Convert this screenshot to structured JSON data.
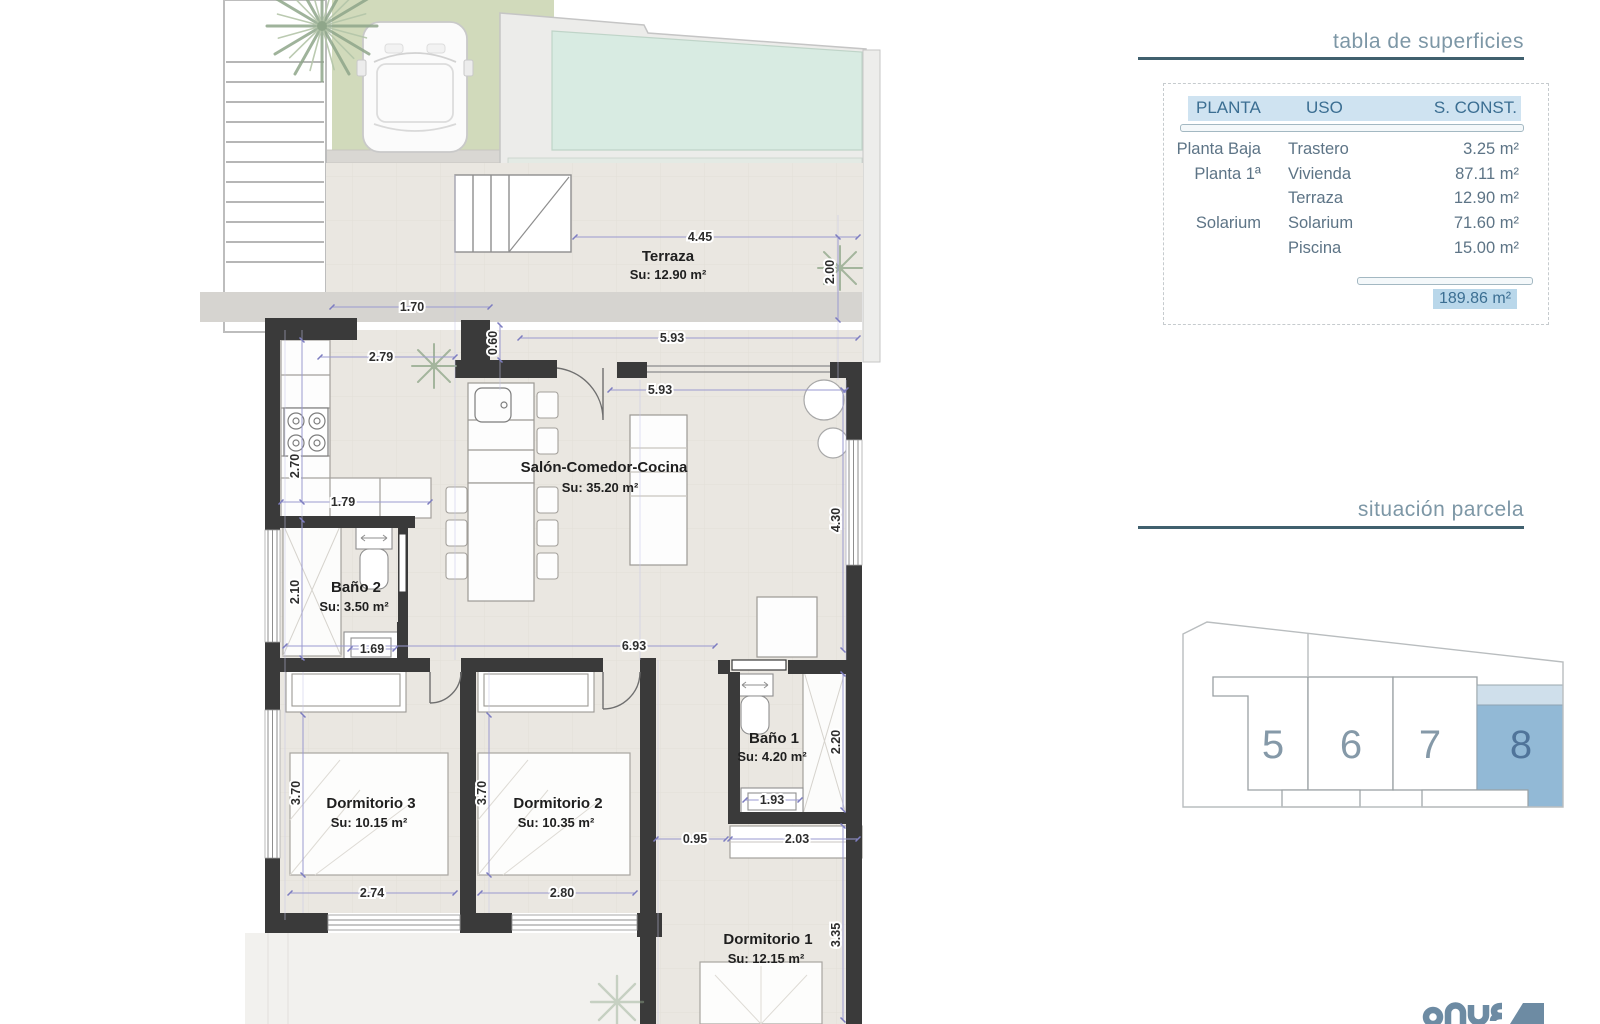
{
  "panel": {
    "surfaces_title": "tabla de superficies",
    "parcel_title": "situación parcela",
    "table": {
      "headers": [
        "PLANTA",
        "USO",
        "S. CONST."
      ],
      "rows": [
        {
          "planta": "Planta Baja",
          "uso": "Trastero",
          "sconst": "3.25 m²"
        },
        {
          "planta": "Planta 1ª",
          "uso": "Vivienda",
          "sconst": "87.11 m²"
        },
        {
          "planta": "",
          "uso": "Terraza",
          "sconst": "12.90 m²"
        },
        {
          "planta": "Solarium",
          "uso": "Solarium",
          "sconst": "71.60 m²"
        },
        {
          "planta": "",
          "uso": "Piscina",
          "sconst": "15.00 m²"
        }
      ],
      "total": "189.86 m²"
    },
    "plots": {
      "p5": "5",
      "p6": "6",
      "p7": "7",
      "p8": "8",
      "highlighted": "8"
    }
  },
  "plan": {
    "rooms": {
      "terraza": {
        "name": "Terraza",
        "su": "Su: 12.90 m²"
      },
      "salon": {
        "name": "Salón-Comedor-Cocina",
        "su": "Su: 35.20 m²"
      },
      "bano2": {
        "name": "Baño 2",
        "su": "Su: 3.50 m²"
      },
      "bano1": {
        "name": "Baño 1",
        "su": "Su: 4.20 m²"
      },
      "dorm3": {
        "name": "Dormitorio 3",
        "su": "Su: 10.15 m²"
      },
      "dorm2": {
        "name": "Dormitorio 2",
        "su": "Su: 10.35 m²"
      },
      "dorm1": {
        "name": "Dormitorio 1",
        "su": "Su: 12.15 m²"
      }
    },
    "dims": {
      "d445": "4.45",
      "d200": "2.00",
      "d170": "1.70",
      "d060": "0.60",
      "d593a": "5.93",
      "d593b": "5.93",
      "d279": "2.79",
      "d270": "2.70",
      "d179": "1.79",
      "d210": "2.10",
      "d169": "1.69",
      "d693": "6.93",
      "d430": "4.30",
      "d220": "2.20",
      "d193": "1.93",
      "d095": "0.95",
      "d203": "2.03",
      "d335": "3.35",
      "d370a": "3.70",
      "d370b": "3.70",
      "d274": "2.74",
      "d280": "2.80"
    }
  },
  "colors": {
    "wall": "#3a3a3a",
    "floor": "#eae7e1",
    "pool": "#d8ebe2",
    "grass": "#cdd8b6",
    "dimline": "#9a9ad0",
    "header_bg": "#cfe3f1",
    "header_text": "#3b6e92",
    "total_bg": "#b9d7ea",
    "plot_blue": "#92b9d6",
    "plot_blue_light": "#cfdfeb",
    "title_text": "#7d97a6"
  }
}
